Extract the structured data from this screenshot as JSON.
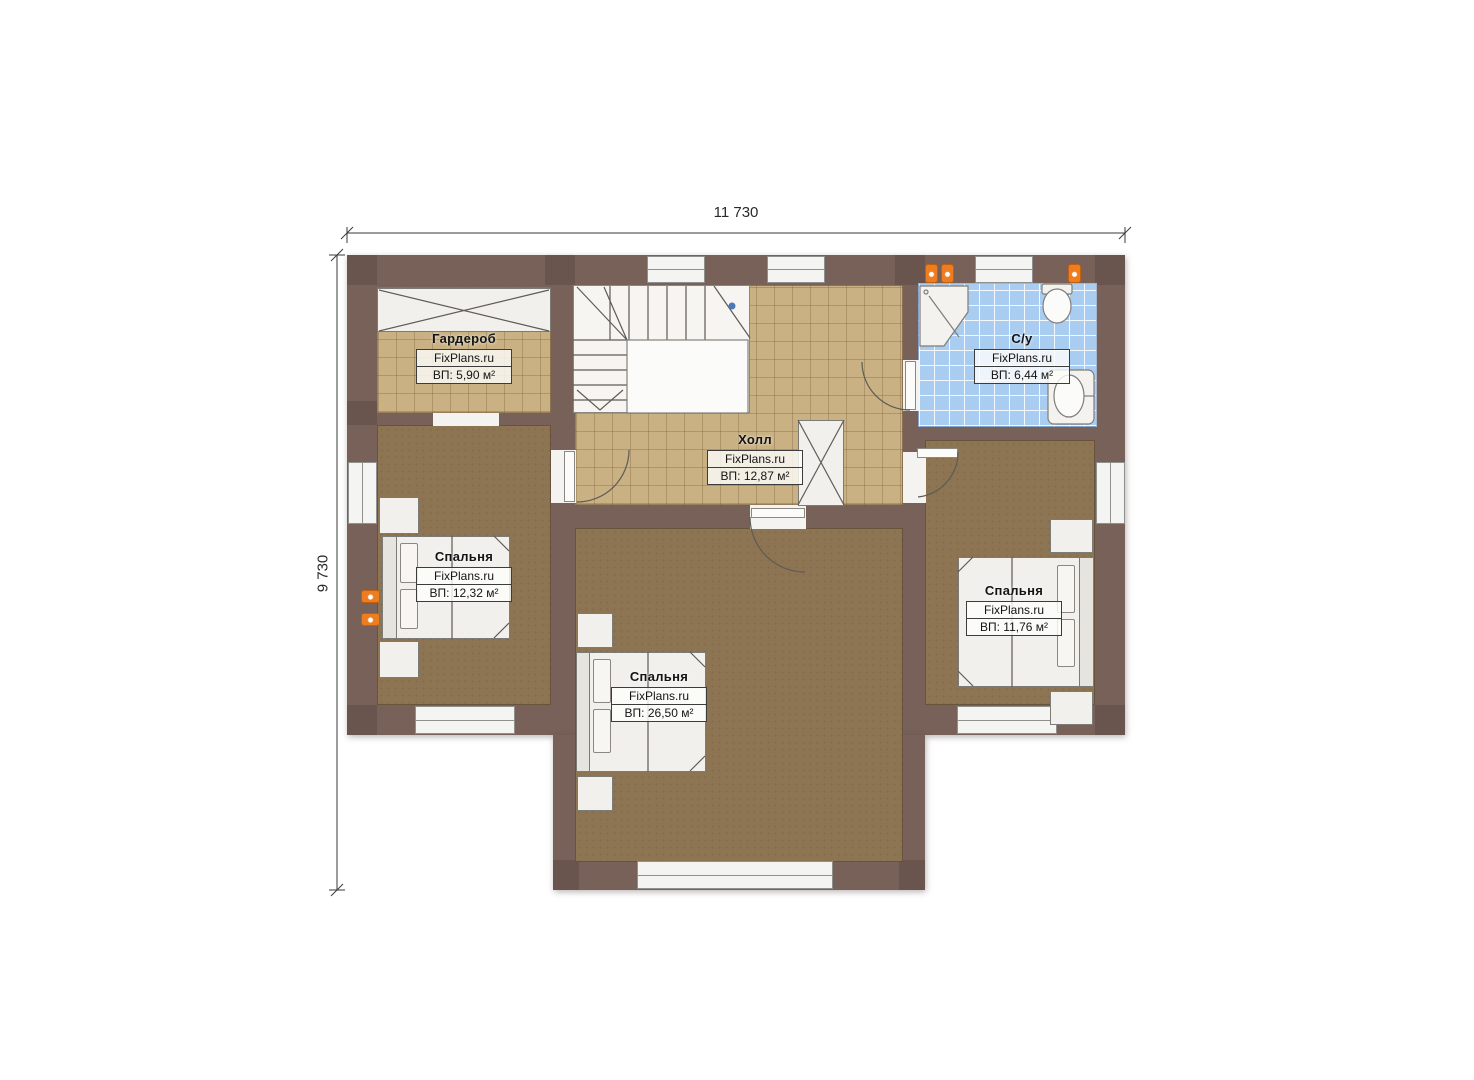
{
  "dimensions": {
    "width": "11 730",
    "height": "9 730"
  },
  "rooms": [
    {
      "id": "wardrobe",
      "name": "Гардероб",
      "brand": "FixPlans.ru",
      "area": "ВП: 5,90 м²"
    },
    {
      "id": "hall",
      "name": "Холл",
      "brand": "FixPlans.ru",
      "area": "ВП: 12,87 м²"
    },
    {
      "id": "bathroom",
      "name": "С/у",
      "brand": "FixPlans.ru",
      "area": "ВП: 6,44 м²"
    },
    {
      "id": "bedroom-left",
      "name": "Спальня",
      "brand": "FixPlans.ru",
      "area": "ВП: 12,32 м²"
    },
    {
      "id": "bedroom-main",
      "name": "Спальня",
      "brand": "FixPlans.ru",
      "area": "ВП: 26,50 м²"
    },
    {
      "id": "bedroom-right",
      "name": "Спальня",
      "brand": "FixPlans.ru",
      "area": "ВП: 11,76 м²"
    }
  ],
  "colors": {
    "wall": "#776158",
    "floor_tile": "#c9b183",
    "carpet": "#8d7452",
    "bath_tile": "#a9cdf1",
    "stair_floor": "#f6f5f2",
    "lamp_accent": "#ee7d1f",
    "stair_marker": "#4a7ab5"
  }
}
